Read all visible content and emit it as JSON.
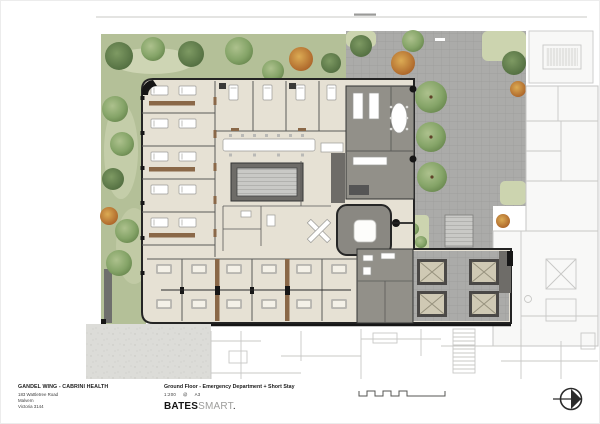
{
  "title_block": {
    "project_name": "GANDEL WING  -  CABRINI HEALTH",
    "address": [
      "183 Wattletree Road",
      "Malvern",
      "Victoria 3144"
    ],
    "drawing_title": "Ground Floor - Emergency Department + Short Stay",
    "scale": "1:200",
    "scale_separator": "@",
    "sheet_size": "A3",
    "logo_bold": "BATES",
    "logo_light": "SMART",
    "logo_suffix": "."
  },
  "legend": {
    "scale_bar": "graphic-scale-bar",
    "north_arrow": "north-arrow"
  },
  "palette": {
    "lawn": "#b4c098",
    "lawn_light": "#ccd4af",
    "tree_green": "#85a468",
    "tree_dark": "#5d7a4a",
    "tree_autumn": "#bf7a33",
    "paving": "#ababa9",
    "floor": "#e6e1d4",
    "floor_dark": "#dcd7c9",
    "gray_room": "#929089",
    "gray_dark": "#6e6c68",
    "wall": "#242424",
    "door_brown": "#8a6848",
    "concrete": "#dcdcd8",
    "existing_bg": "#f8f8f7",
    "existing_line": "#c8c8c6",
    "ink": "#2b2b2b"
  }
}
